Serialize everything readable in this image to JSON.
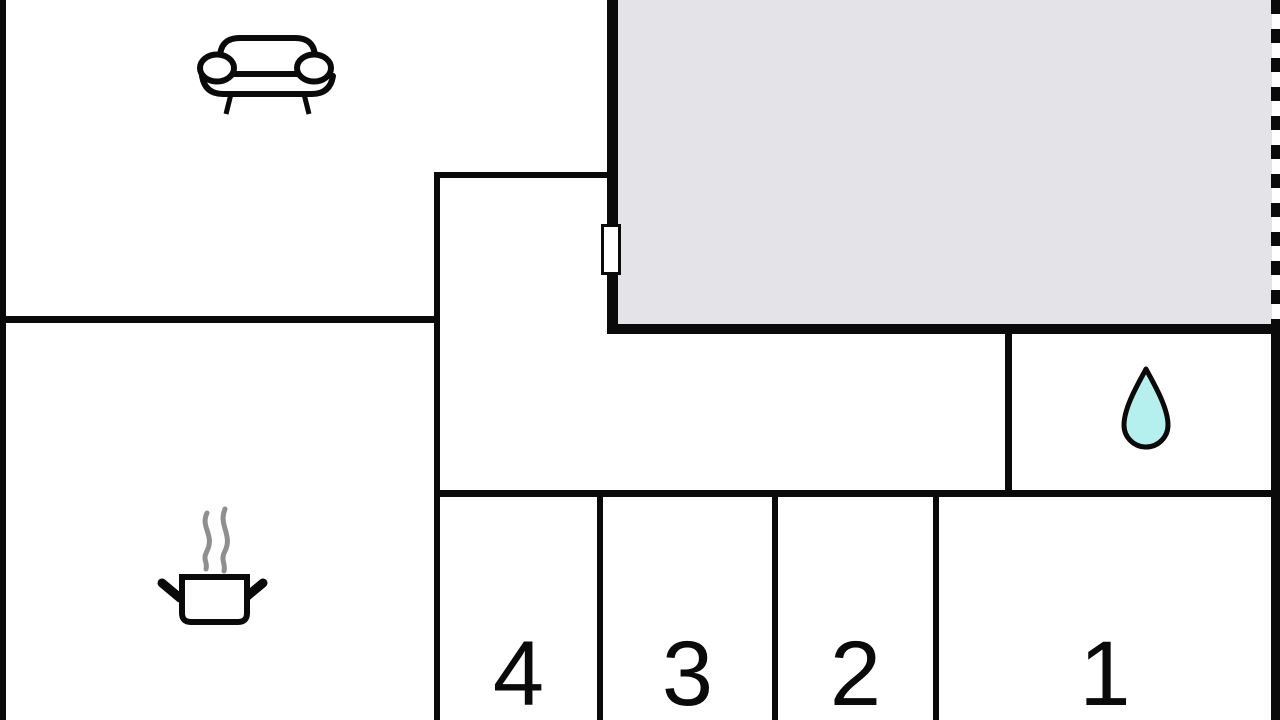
{
  "plan": {
    "colors": {
      "wall": "#0a0a0a",
      "bg": "#ffffff",
      "terrace_fill": "#e4e4e8",
      "drop_fill": "#b5f0ef",
      "steam": "#8f8f8f"
    },
    "rooms": [
      {
        "id": "living-room",
        "icon": "sofa-icon",
        "label": ""
      },
      {
        "id": "terrace",
        "icon": "",
        "label": ""
      },
      {
        "id": "kitchen",
        "icon": "cooking-pot-icon",
        "label": ""
      },
      {
        "id": "bathroom",
        "icon": "water-drop-icon",
        "label": ""
      },
      {
        "id": "room-4",
        "icon": "",
        "label": "4"
      },
      {
        "id": "room-3",
        "icon": "",
        "label": "3"
      },
      {
        "id": "room-2",
        "icon": "",
        "label": "2"
      },
      {
        "id": "room-1",
        "icon": "",
        "label": "1"
      }
    ]
  }
}
